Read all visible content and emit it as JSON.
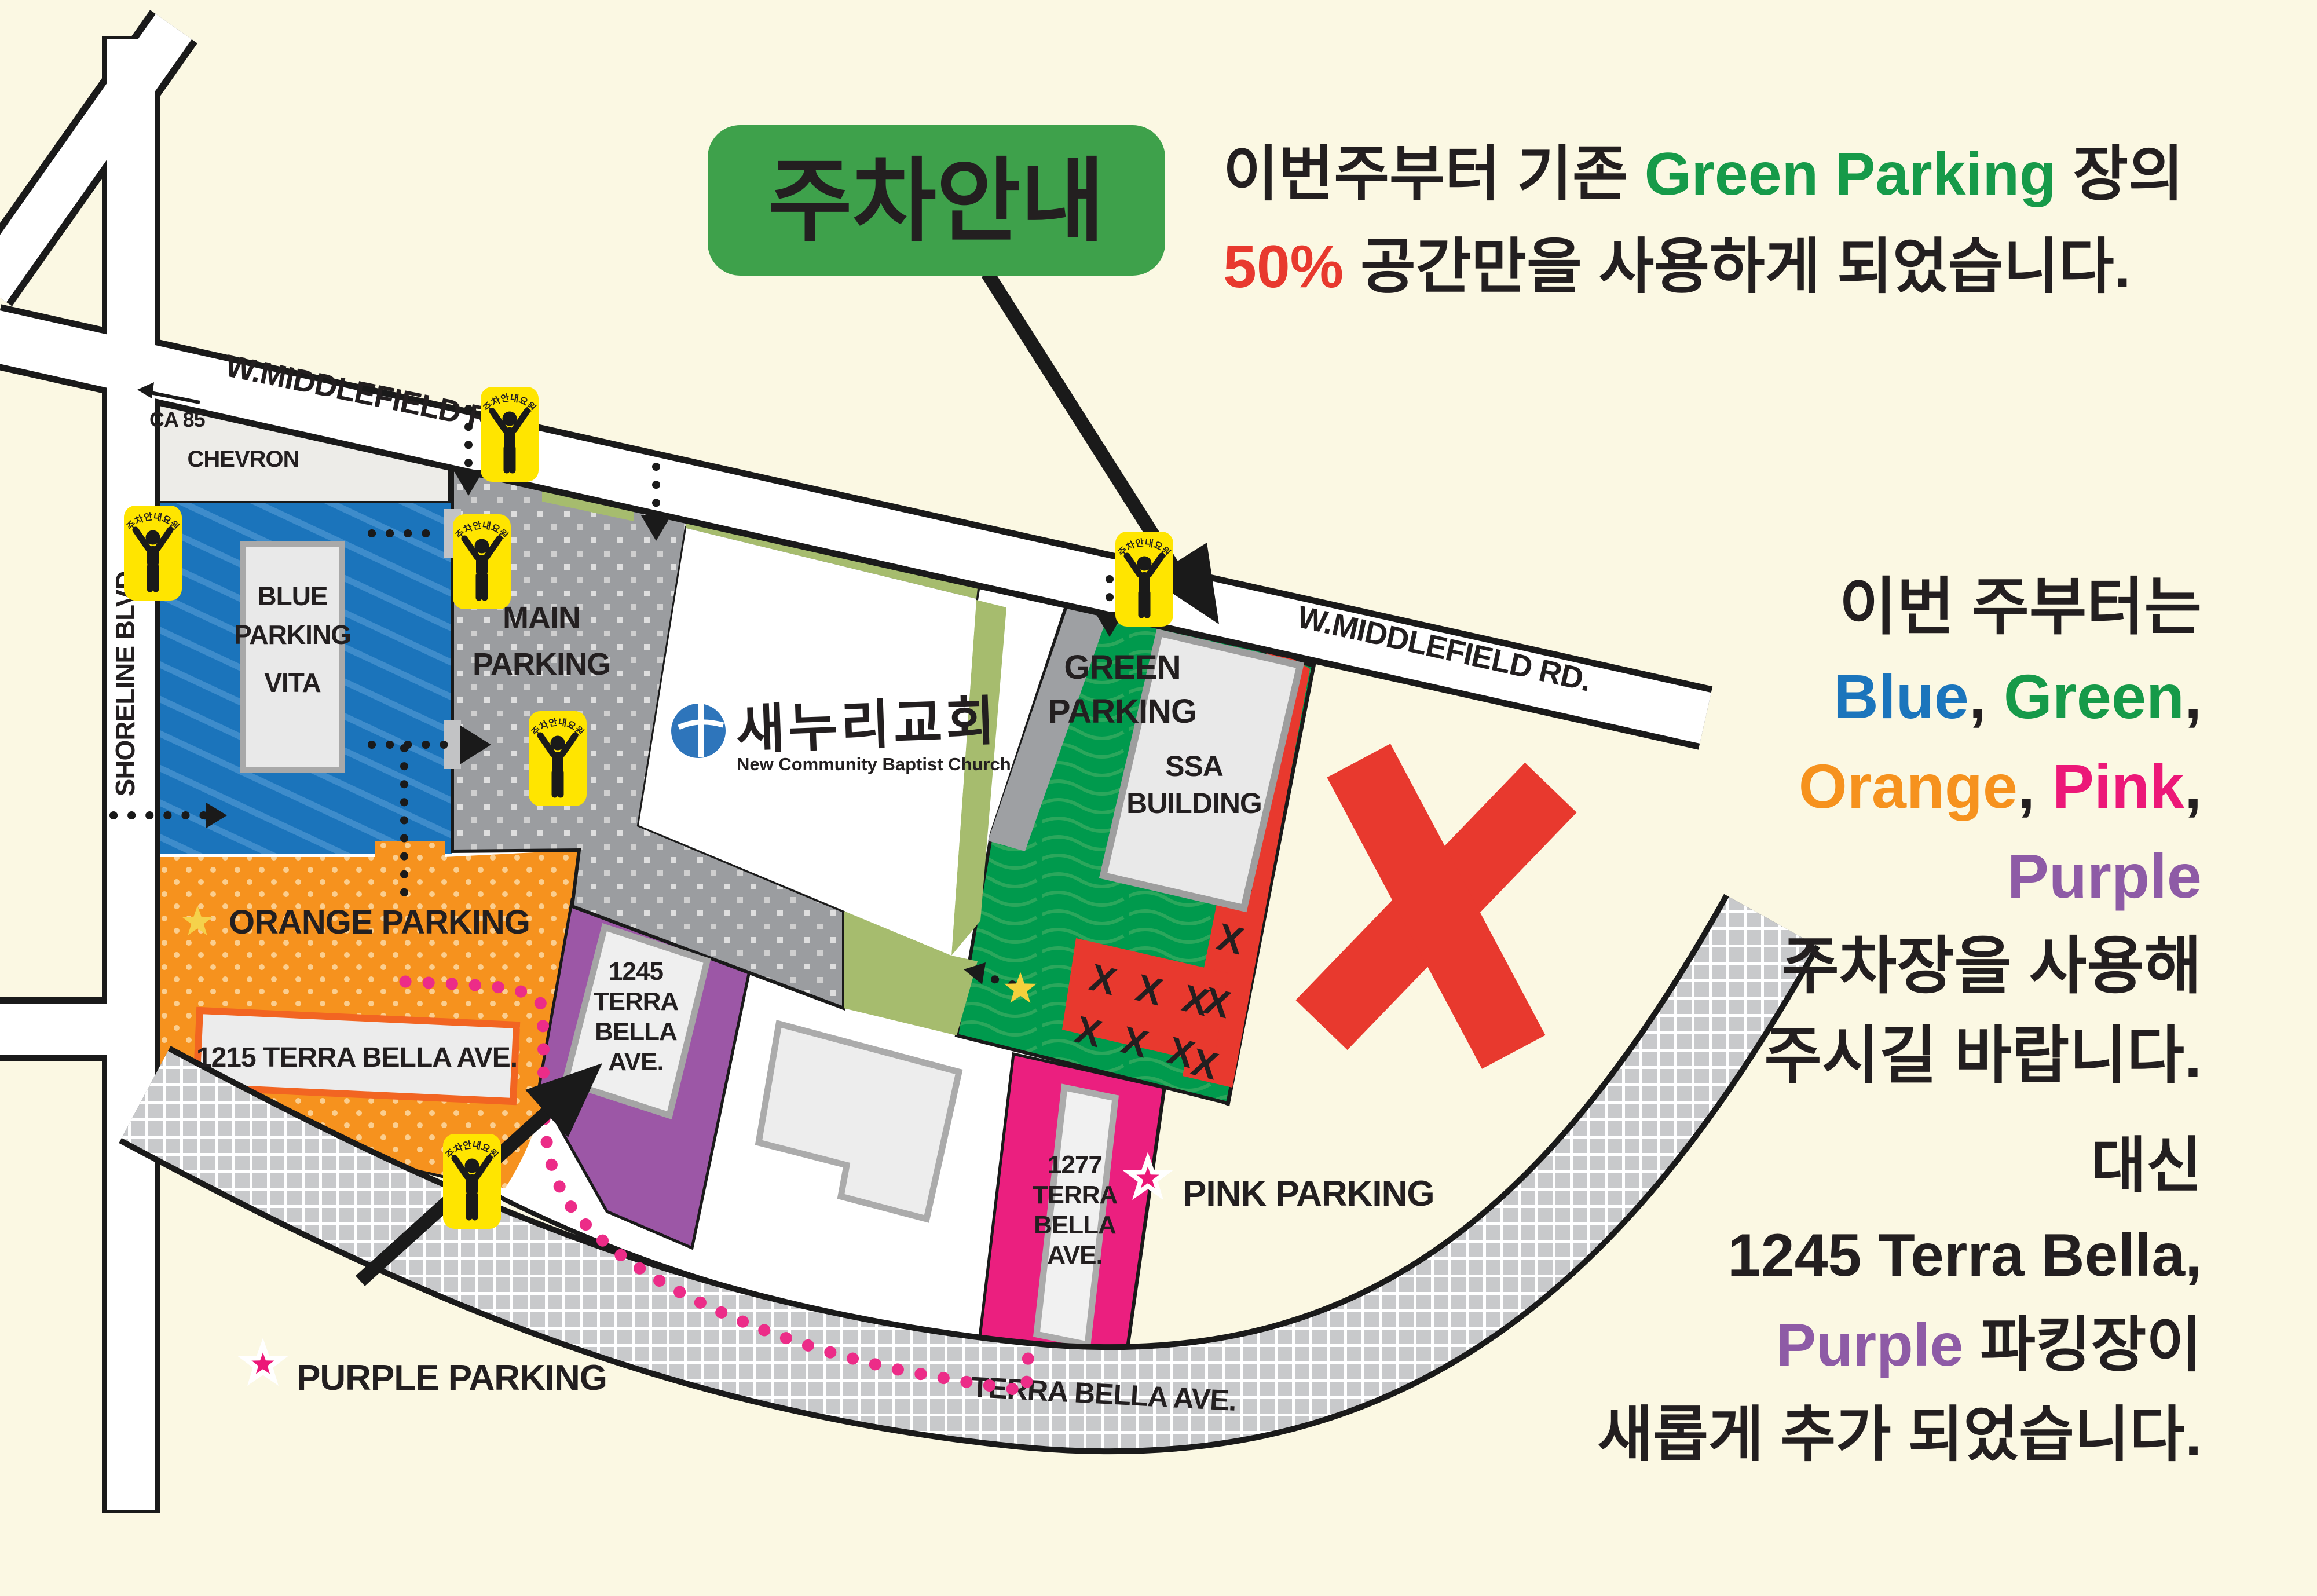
{
  "notice_badge": {
    "label": "주차안내"
  },
  "headline": {
    "line1_pre": "이번주부터 기존 ",
    "line1_green": "Green Parking",
    "line1_post": " 장의",
    "line2_red": "50%",
    "line2_rest": " 공간만을 사용하게  되었습니다."
  },
  "side_note": {
    "line1": "이번 주부터는",
    "blue": "Blue",
    "green": "Green",
    "orange": "Orange",
    "pink": "Pink",
    "purple": "Purple",
    "comma": ", ",
    "comma_end": ",",
    "line5": "주차장을 사용해",
    "line6": "주시길 바랍니다."
  },
  "bottom_note": {
    "line1": "대신",
    "line2": "1245 Terra Bella,",
    "line3_purple": "Purple",
    "line3_rest": " 파킹장이",
    "line4": "새롭게 추가 되었습니다."
  },
  "roads": {
    "shoreline": "SHORELINE BLVD.",
    "middlefield": "W.MIDDLEFIELD RD.",
    "terra_bella": "TERRA BELLA AVE.",
    "ca85": "CA 85"
  },
  "zones": {
    "chevron": "CHEVRON",
    "blue": [
      "BLUE",
      "PARKING",
      "VITA"
    ],
    "main": [
      "MAIN",
      "PARKING"
    ],
    "green": [
      "GREEN",
      "PARKING"
    ],
    "ssa": [
      "SSA",
      "BUILDING"
    ],
    "orange": "ORANGE PARKING",
    "b1215": "1215 TERRA BELLA AVE.",
    "b1245": [
      "1245",
      "TERRA",
      "BELLA",
      "AVE."
    ],
    "b1277": [
      "1277",
      "TERRA",
      "BELLA",
      "AVE."
    ]
  },
  "markers": {
    "pink_parking": "PINK PARKING",
    "purple_parking": "PURPLE PARKING",
    "attendant": "주차안내요원",
    "x": "X"
  },
  "church": {
    "name_kr": "새누리교회",
    "name_en": "New Community Baptist Church"
  },
  "colors": {
    "background": "#FBF8E3",
    "badge_green": "#3EA14B",
    "accent_green": "#169A49",
    "accent_red": "#E8392E",
    "accent_blue": "#1B75BC",
    "accent_orange": "#F6921E",
    "accent_pink": "#EC1878",
    "accent_purple": "#8E5BA6",
    "zone_blue": "#1B74BB",
    "zone_gray": "#9B9DA0",
    "zone_green": "#009A4D",
    "zone_orange": "#F6921E",
    "zone_purple": "#9C57A6",
    "zone_pink": "#EB1F7F",
    "attendant_yellow": "#FFE500",
    "church_blue": "#2E75BB"
  }
}
